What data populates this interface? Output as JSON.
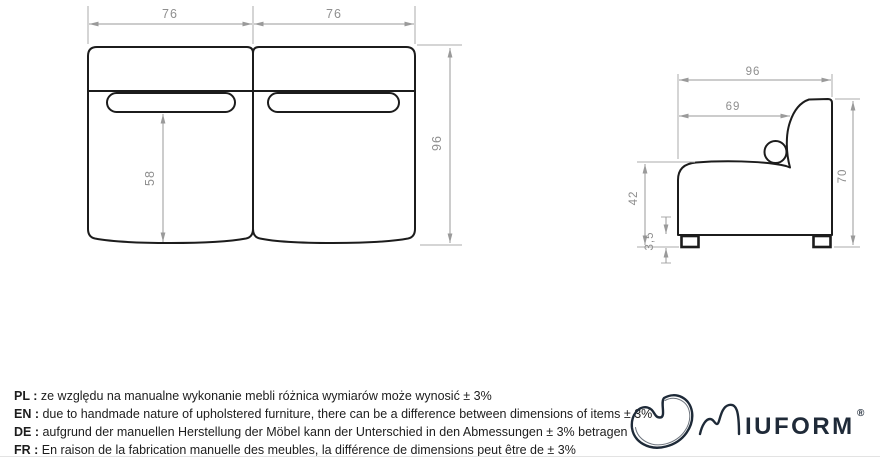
{
  "front_view": {
    "module_width_left": "76",
    "module_width_right": "76",
    "total_height": "96",
    "slot_to_bottom": "58"
  },
  "side_view": {
    "total_depth": "96",
    "seat_depth": "69",
    "back_height": "70",
    "seat_height": "42",
    "leg_height": "3,5"
  },
  "notes": [
    {
      "lang": "PL :",
      "text": "ze względu na manualne wykonanie mebli różnica wymiarów może wynosić ± 3%"
    },
    {
      "lang": "EN :",
      "text": "due to handmade nature of upholstered furniture, there can be a difference between dimensions of items ± 3%"
    },
    {
      "lang": "DE :",
      "text": "aufgrund der manuellen Herstellung der Möbel kann der Unterschied in den Abmessungen ± 3% betragen"
    },
    {
      "lang": "FR :",
      "text": "En raison de la fabrication manuelle des meubles, la différence de dimensions peut être de ± 3%"
    }
  ],
  "logo": {
    "wordmark": "IUFORM",
    "registered": "®"
  },
  "colors": {
    "outline": "#1c1c1c",
    "dimension_line": "#9a9a9a",
    "dimension_text": "#8f8f8f",
    "logo": "#1e2a38"
  }
}
